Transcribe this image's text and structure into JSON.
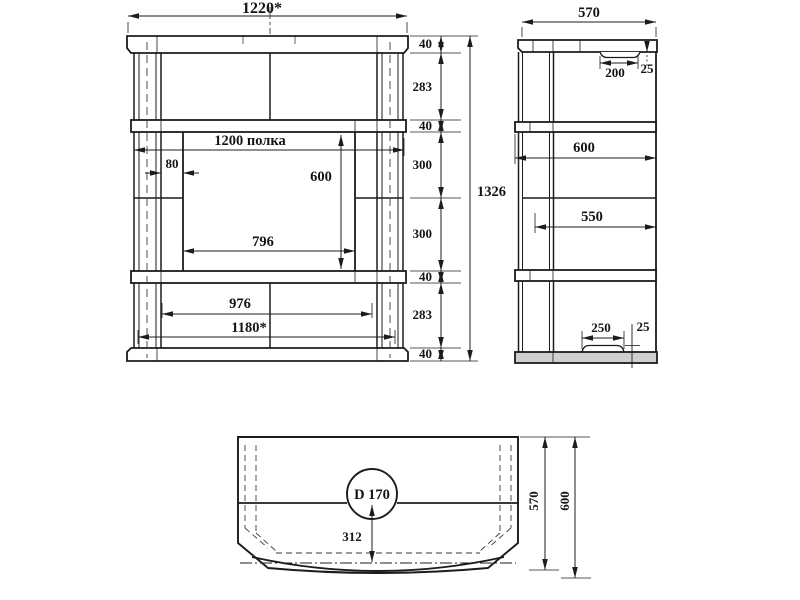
{
  "front": {
    "width_top": "1220*",
    "height_total": "1326",
    "chain": [
      "40",
      "283",
      "40",
      "300",
      "300",
      "40",
      "283",
      "40"
    ],
    "shelf_width": "1200 полка",
    "post_inset": "80",
    "opening_height": "600",
    "opening_width": "796",
    "bottom_inner_width": "976",
    "width_bottom": "1180*"
  },
  "side": {
    "depth": "570",
    "top_recess_width": "200",
    "top_recess_depth": "25",
    "shelf_depth": "600",
    "clear_depth": "550",
    "foot_pad_width": "250",
    "foot_pad_height": "25"
  },
  "plan": {
    "hole_label": "D 170",
    "hole_center_offset": "312",
    "depth_to_edge": "570",
    "depth_total": "600"
  }
}
